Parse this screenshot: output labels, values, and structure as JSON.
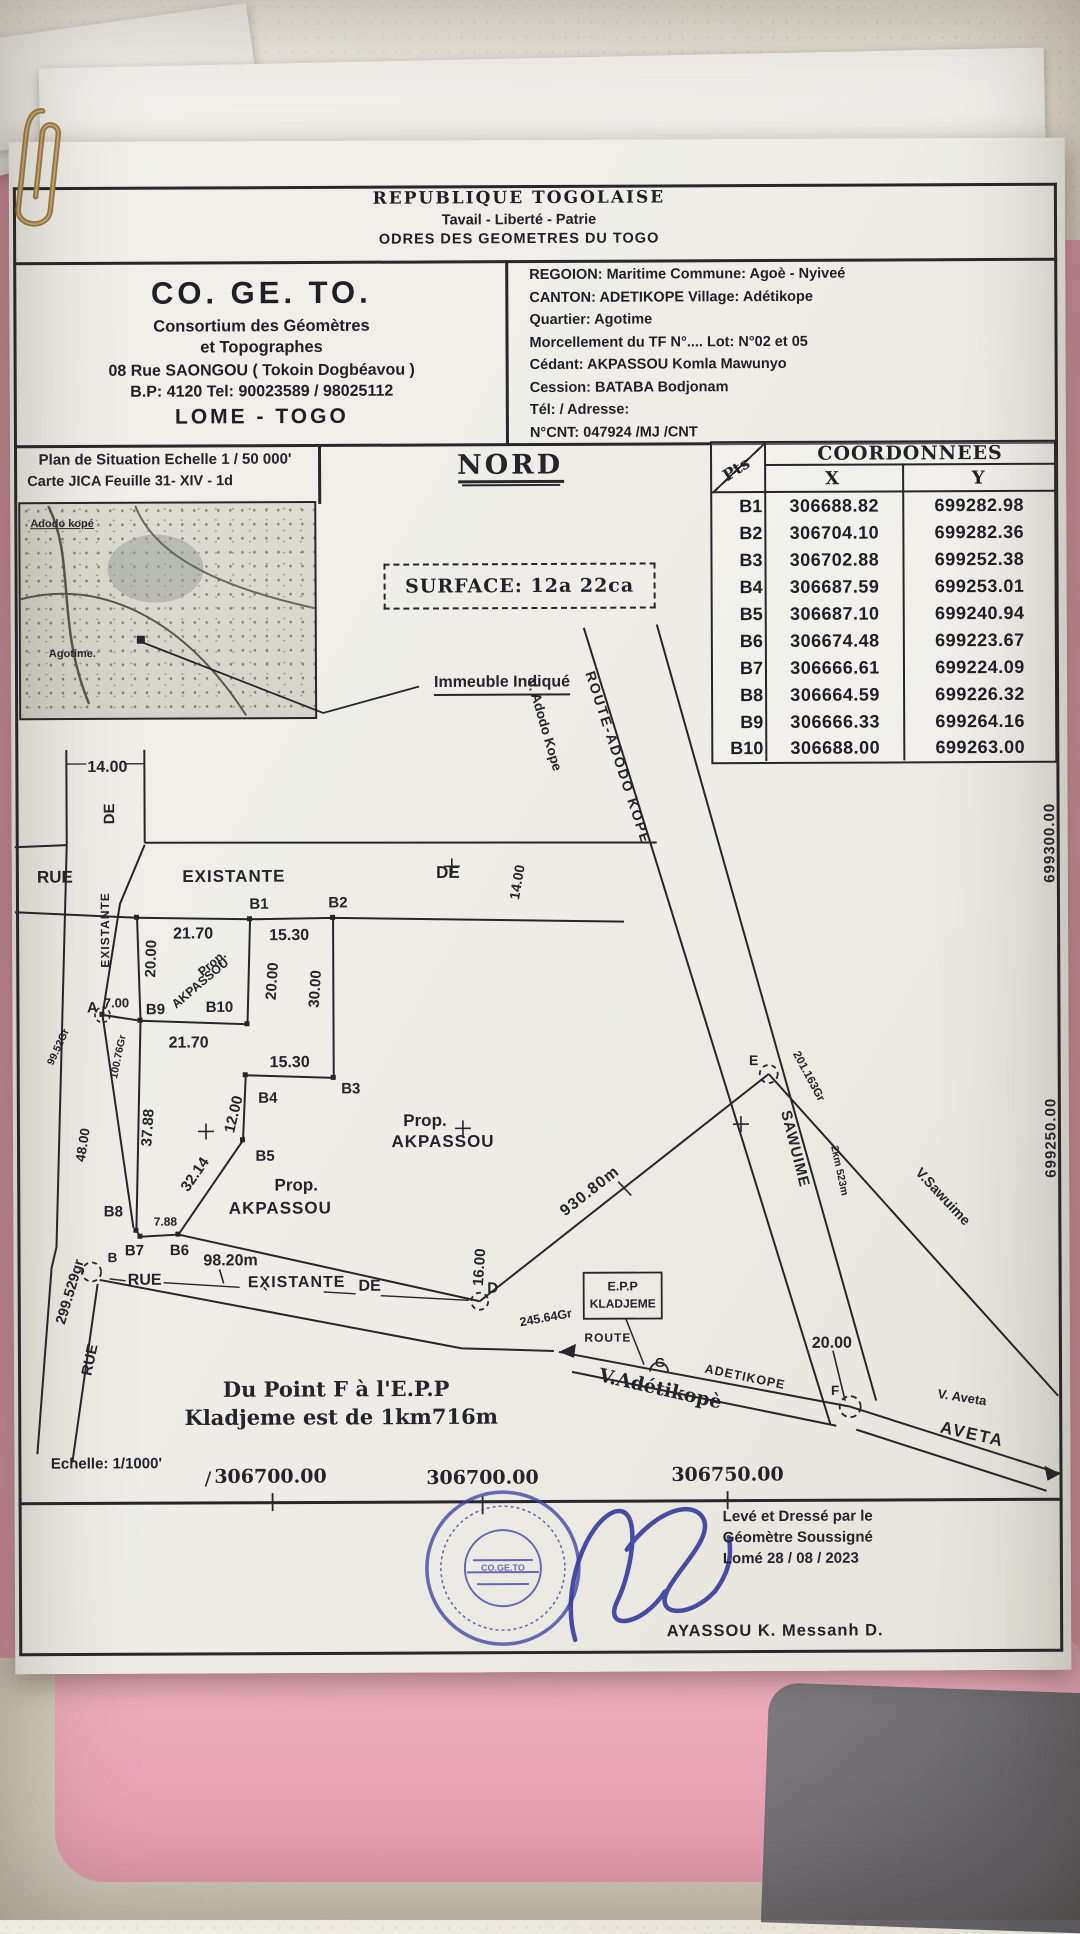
{
  "header": {
    "country": "REPUBLIQUE  TOGOLAISE",
    "motto": "Tavail - Liberté - Patrie",
    "order": "ODRES DES GEOMETRES DU TOGO"
  },
  "firm": {
    "name": "CO. GE. TO.",
    "line1": "Consortium des Géomètres",
    "line2": "et Topographes",
    "line3": "08 Rue SAONGOU  ( Tokoin Dogbéavou )",
    "line4": "B.P: 4120 Tel: 90023589 / 98025112",
    "line5": "LOME - TOGO"
  },
  "location": {
    "lines": [
      "REGOION:  Maritime    Commune:   Agoè - Nyiveé",
      "CANTON:  ADETIKOPE        Village:   Adétikope",
      "Quartier:   Agotime",
      "Morcellement du TF N°.... Lot: N°02 et 05",
      "Cédant:  AKPASSOU  Komla   Mawunyo",
      "Cession:  BATABA       Bodjonam",
      "Tél:    /      Adresse:",
      "N°CNT:  047924 /MJ /CNT"
    ]
  },
  "situation": {
    "title": "Plan de Situation Echelle 1 / 50 000'",
    "subtitle": "Carte JICA Feuille  31- XIV - 1d",
    "village1": "Adodo kopé",
    "village2": "Agotime."
  },
  "north_label": "NORD",
  "surface_label": "SURFACE:  12a 22ca",
  "building_note": "Immeuble Indiqué",
  "coords": {
    "pts": "Pts",
    "title": "COORDONNEES",
    "x": "X",
    "y": "Y",
    "rows": [
      {
        "pt": "B1",
        "x": "306688.82",
        "y": "699282.98"
      },
      {
        "pt": "B2",
        "x": "306704.10",
        "y": "699282.36"
      },
      {
        "pt": "B3",
        "x": "306702.88",
        "y": "699252.38"
      },
      {
        "pt": "B4",
        "x": "306687.59",
        "y": "699253.01"
      },
      {
        "pt": "B5",
        "x": "306687.10",
        "y": "699240.94"
      },
      {
        "pt": "B6",
        "x": "306674.48",
        "y": "699223.67"
      },
      {
        "pt": "B7",
        "x": "306666.61",
        "y": "699224.09"
      },
      {
        "pt": "B8",
        "x": "306664.59",
        "y": "699226.32"
      },
      {
        "pt": "B9",
        "x": "306666.33",
        "y": "699264.16"
      },
      {
        "pt": "B10",
        "x": "306688.00",
        "y": "699263.00"
      }
    ]
  },
  "plan": {
    "rue": "RUE",
    "existante": "EXISTANTE",
    "de": "DE",
    "w14": "14.00",
    "w16": "16.00",
    "w7": "7.00",
    "d2170": "21.70",
    "d1530": "15.30",
    "d2000": "20.00",
    "d3000": "30.00",
    "d1200": "12.00",
    "d3788": "37.88",
    "d3214": "32.14",
    "d4800": "48.00",
    "d788": "7.88",
    "d9820": "98.20m",
    "d93080": "930.80m",
    "d2km": "2km 523m",
    "prop": "Prop.",
    "akpassou": "AKPASSOU",
    "pts": {
      "a": "A",
      "b": "B",
      "b1": "B1",
      "b2": "B2",
      "b3": "B3",
      "b4": "B4",
      "b5": "B5",
      "b6": "B6",
      "b7": "B7",
      "b8": "B8",
      "b9": "B9",
      "b10": "B10",
      "d": "D",
      "e": "E",
      "f": "F",
      "g": "G"
    },
    "angles": {
      "a245": "245.64Gr",
      "a201": "201.163Gr",
      "a299": "299.529gr",
      "a99": "99.52Gr",
      "a100": "100.76Gr"
    },
    "roads": {
      "v_adodo": "V. Adodo Kope",
      "route_adodo": "ROUTE-ADODO KOPE",
      "sawuime": "SAWUIME",
      "v_sawuime": "V.Sawuime",
      "epp_line1": "E.P.P",
      "epp_line2": "KLADJEME",
      "route": "ROUTE",
      "adetikope": "ADETIKOPE",
      "v_adetikope": "V.Adétikopè",
      "v_aveta": "V. Aveta",
      "aveta": "AVETA"
    }
  },
  "grid": {
    "x1": "306700.00",
    "x2": "306700.00",
    "x3": "306750.00",
    "y1": "699300.00",
    "y2": "699250.00"
  },
  "notes": {
    "line1": "Du Point  F à l'E.P.P",
    "line2": "Kladjeme est de 1km716m",
    "scale": "Echelle: 1/1000'"
  },
  "certification": {
    "line1": "Levé et Dressé par le",
    "line2": "Géomètre Soussigné",
    "line3": "Lomé 28 / 08 / 2023",
    "surveyor": "AYASSOU  K.  Messanh  D.",
    "stamp": "CO.GE.TO"
  }
}
